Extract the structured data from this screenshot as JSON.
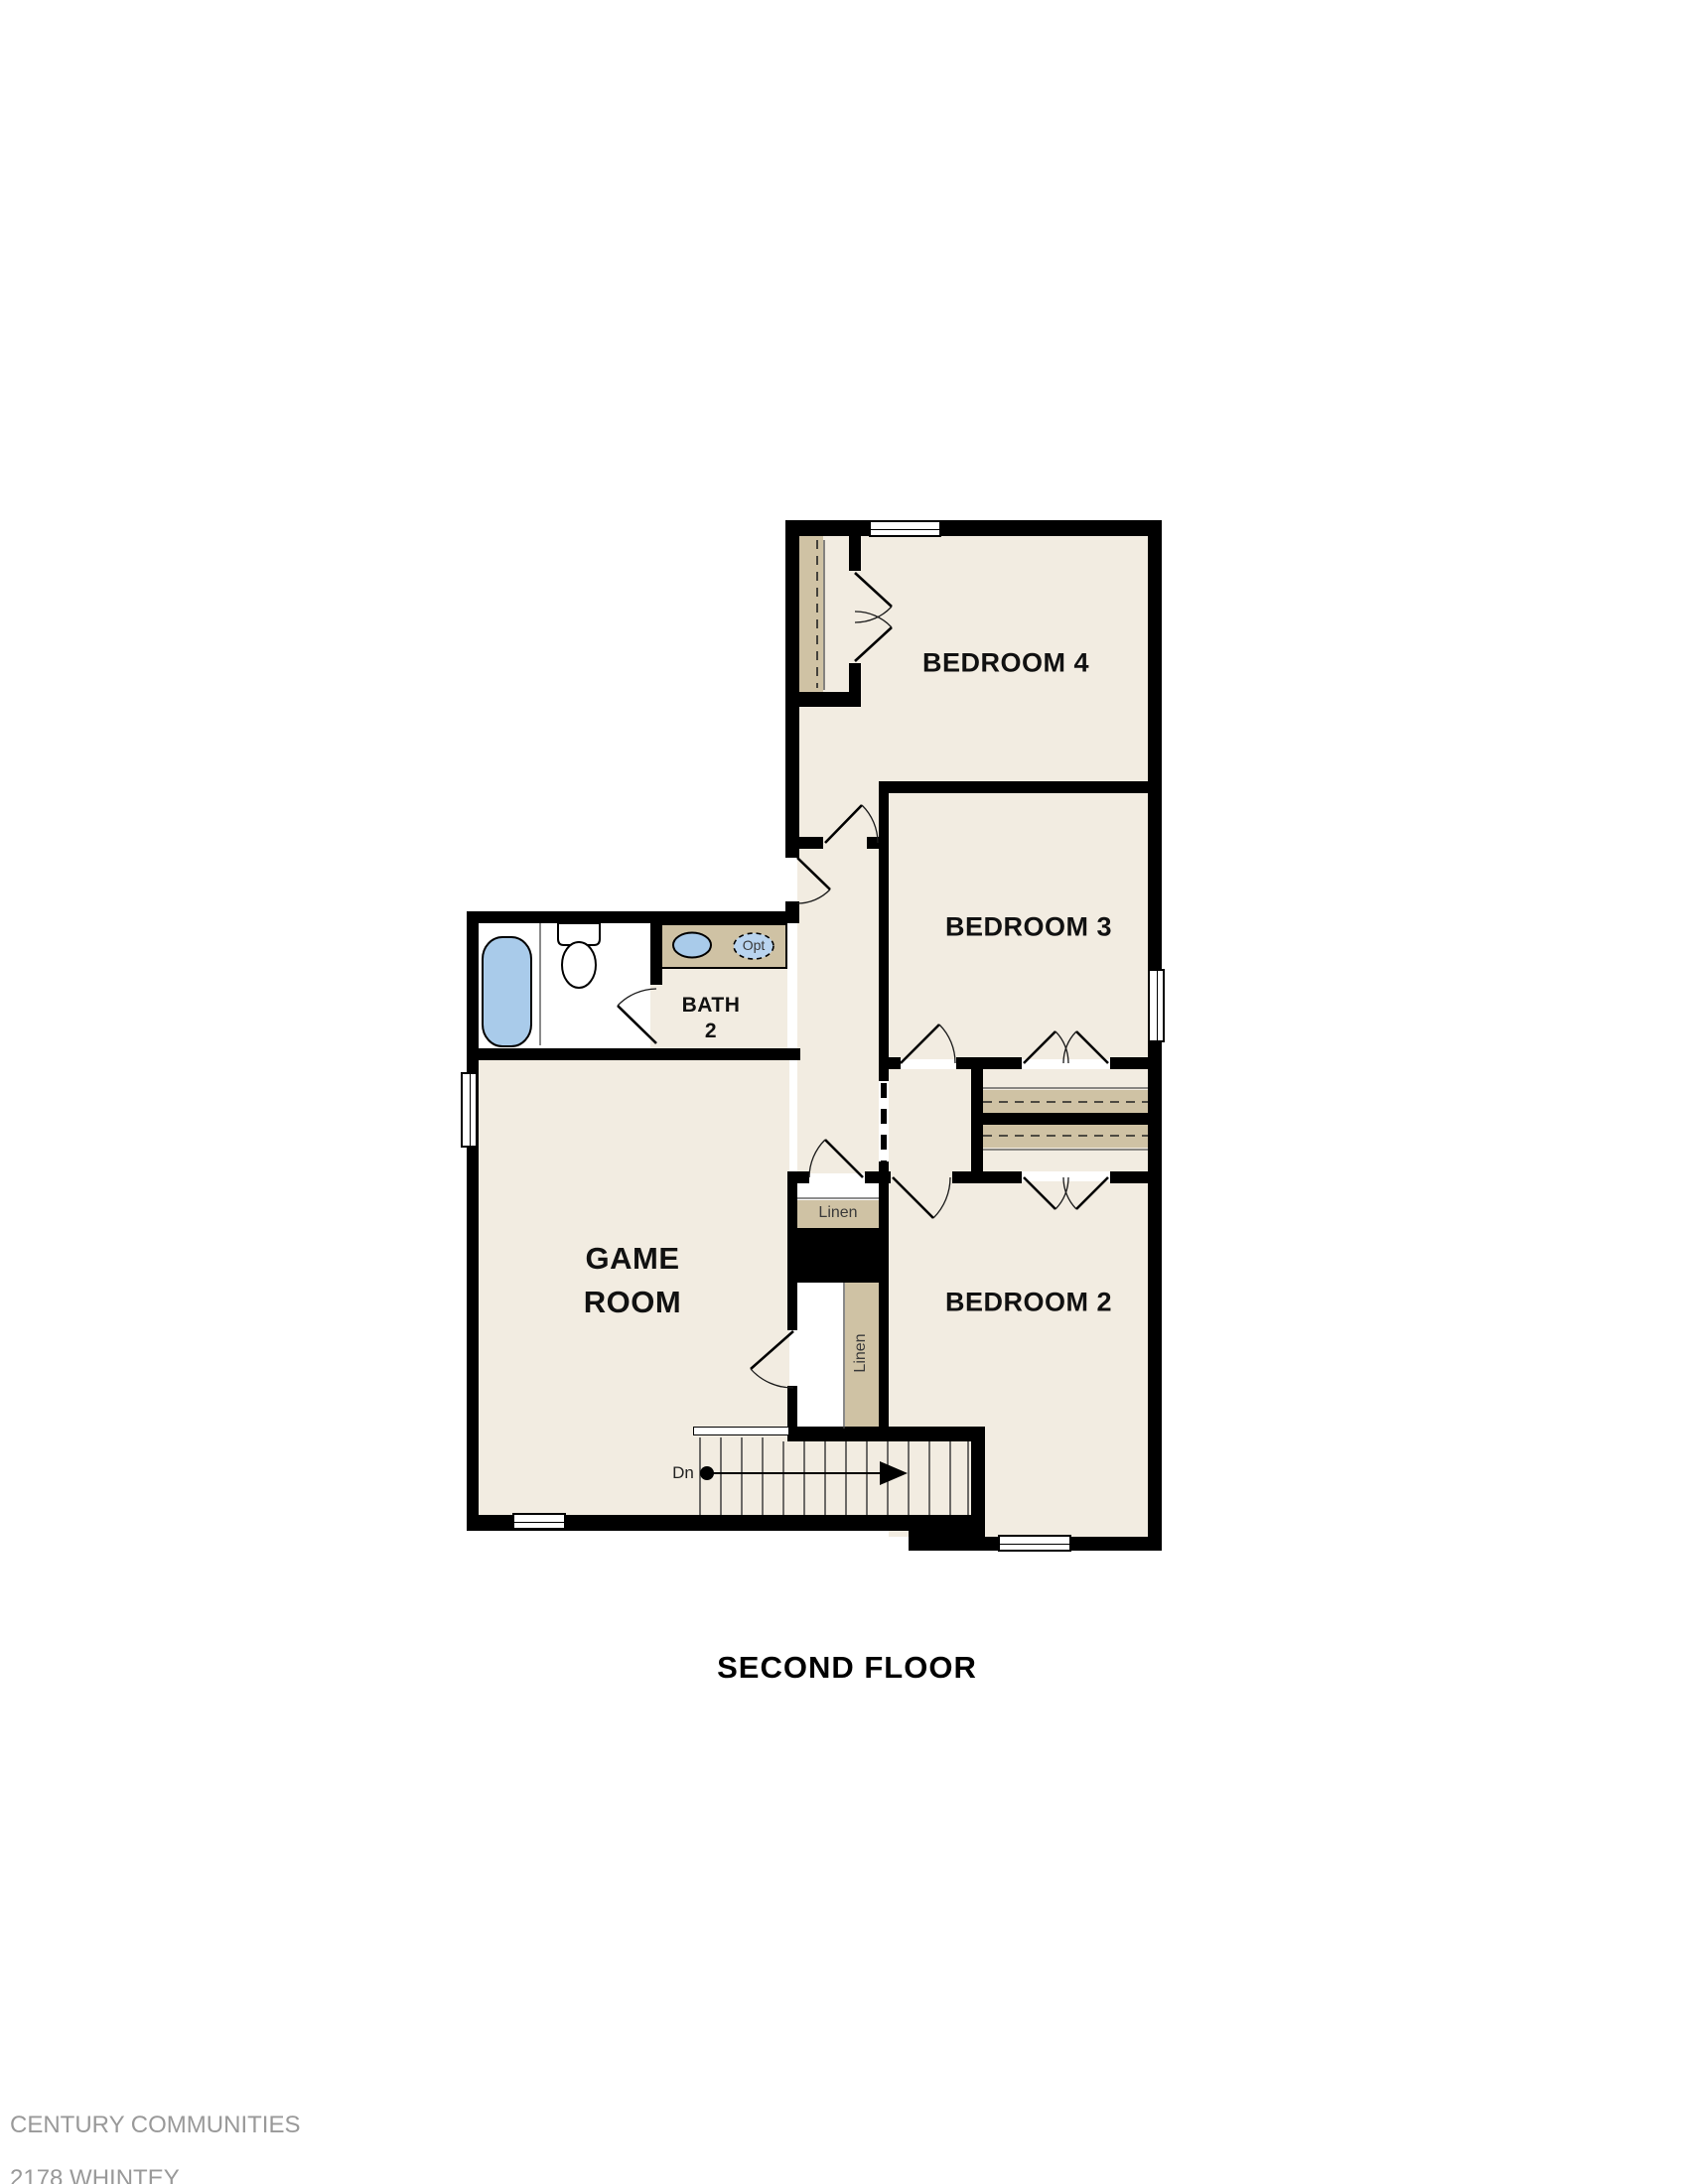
{
  "title": "SECOND FLOOR",
  "footer": {
    "company": "CENTURY COMMUNITIES",
    "plan": "2178 WHINTEY",
    "revision": "REV 01.14.2021"
  },
  "rooms": {
    "bedroom4": {
      "label": "BEDROOM 4"
    },
    "bedroom3": {
      "label": "BEDROOM 3"
    },
    "bedroom2": {
      "label": "BEDROOM 2"
    },
    "bath2": {
      "label_line1": "BATH",
      "label_line2": "2"
    },
    "game_room": {
      "label_line1": "GAME",
      "label_line2": "ROOM"
    }
  },
  "closets": {
    "linen_upper_label": "Linen",
    "linen_lower_label": "Linen"
  },
  "stairs": {
    "direction_label": "Dn"
  },
  "fixtures": {
    "optional_sink_label": "Opt"
  },
  "colors": {
    "wall": "#000000",
    "floor": "#f2ece1",
    "wet_room_floor": "#ffffff",
    "shelf_tan": "#cfc2a4",
    "fixture_blue": "#a9cbea",
    "footer_text": "#999999"
  }
}
